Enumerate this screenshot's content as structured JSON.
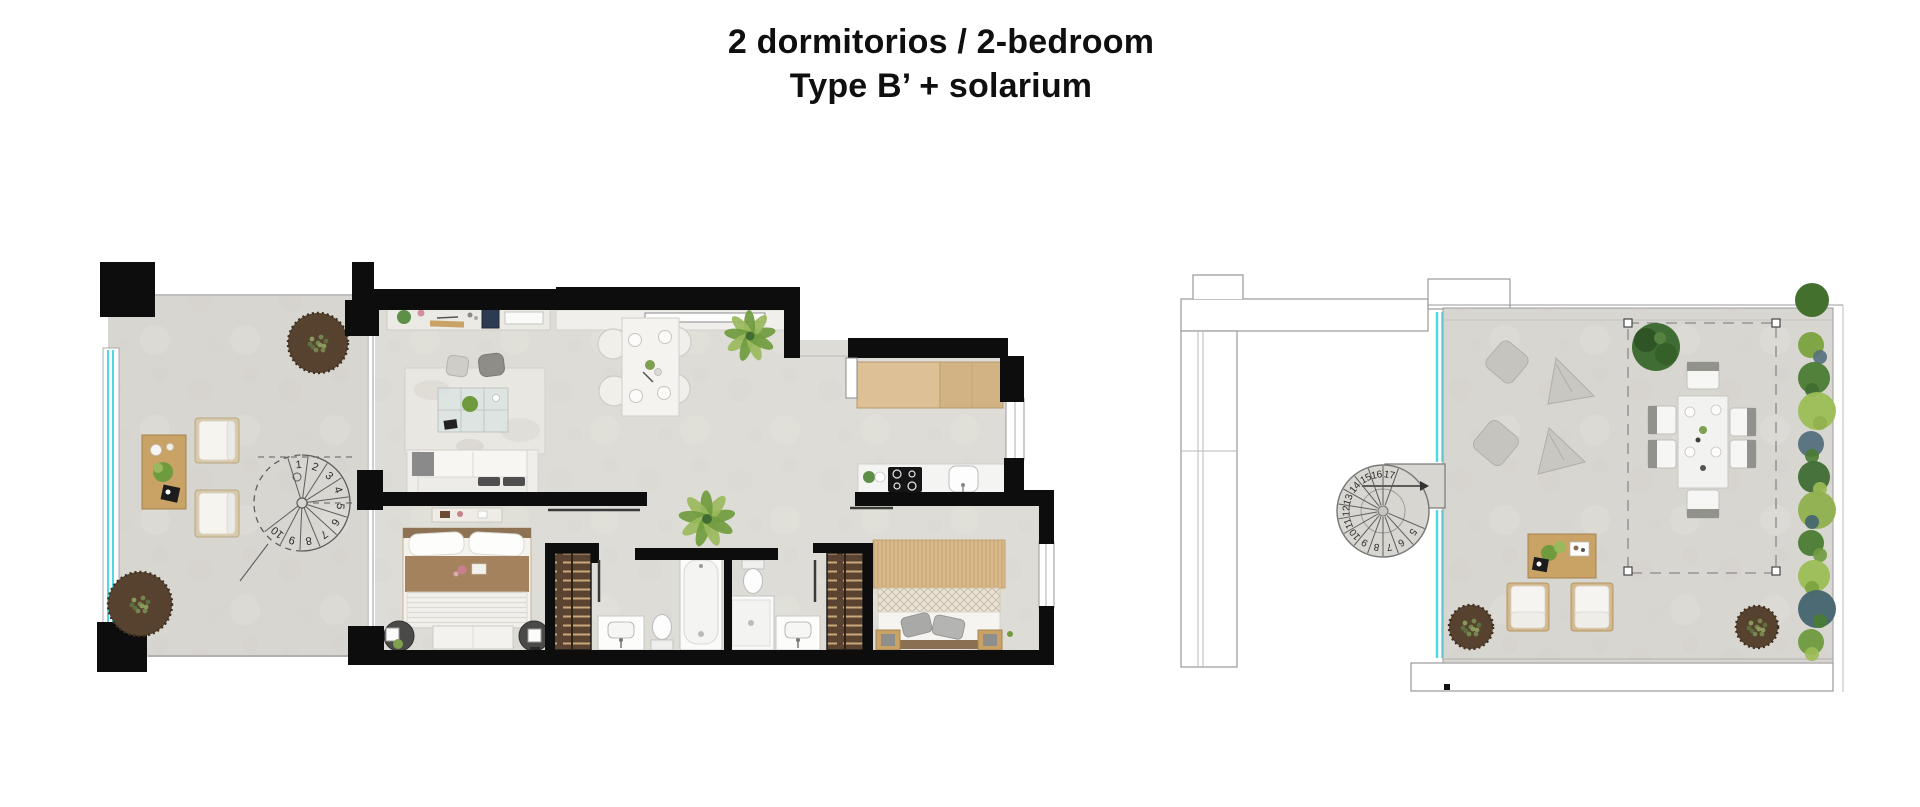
{
  "page": {
    "background": "#ffffff",
    "title": {
      "line1": "2 dormitorios / 2-bedroom",
      "line2": "Type B’ + solarium"
    }
  },
  "colors": {
    "wall": "#0d0d0d",
    "outline": "#9a9a9a",
    "floor_main": "#dedcd6",
    "floor_terrace": "#d8d6d0",
    "floor_deck": "#d8d6d1",
    "glass": "#4fd8e2",
    "white_fixture": "#fafaf9",
    "wood_light": "#ddc096",
    "wood_mid": "#c9a265",
    "wood_dark": "#a5834e",
    "wardrobe": "#5a4331",
    "wardrobe_slat": "#c9a87a",
    "planter": "#57422f",
    "plant_light": "#9ab85c",
    "plant_mid": "#6f9b3e",
    "plant_dark": "#3f6d33",
    "cushion": "#c6c4bf",
    "charcoal": "#4f4f4f",
    "bed_brown": "#a3825d",
    "bed_tan": "#d9b98c",
    "rug": "#e9e7e2"
  },
  "main_plan": {
    "staircase": {
      "steps": [
        "1",
        "2",
        "3",
        "4",
        "5",
        "6",
        "7",
        "8",
        "9",
        "10"
      ]
    }
  },
  "solarium_plan": {
    "staircase": {
      "steps": [
        "5",
        "6",
        "7",
        "8",
        "9",
        "10",
        "11",
        "12",
        "13",
        "14",
        "15",
        "16",
        "17"
      ]
    }
  }
}
